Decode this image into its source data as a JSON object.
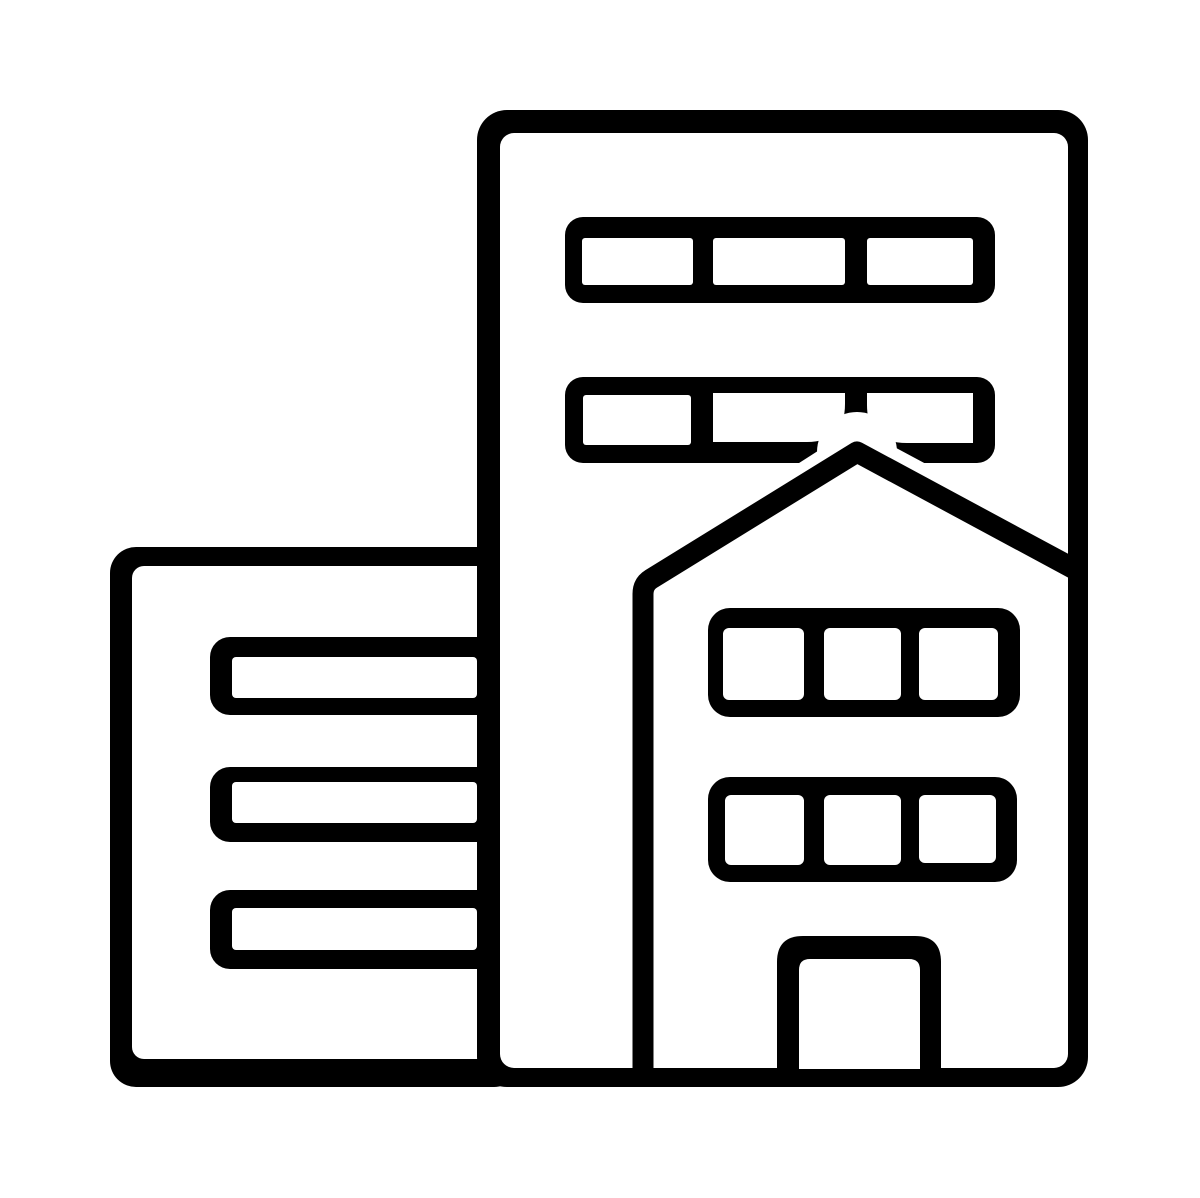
{
  "canvas": {
    "width": 1200,
    "height": 1198,
    "colors": {
      "ink": "#000000",
      "paper": "#ffffff"
    }
  },
  "icon": {
    "label": "city-buildings",
    "shapes": [
      {
        "name": "left-building-body",
        "type": "rect",
        "x": 110,
        "y": 547,
        "w": 410,
        "h": 540,
        "rx": 26,
        "fill": "ink"
      },
      {
        "name": "left-building-interior",
        "type": "rect",
        "x": 132,
        "y": 566,
        "w": 388,
        "h": 493,
        "rx": 12,
        "fill": "paper"
      },
      {
        "name": "left-window-bar-1",
        "type": "rect",
        "x": 210,
        "y": 637,
        "w": 310,
        "h": 78,
        "rx": 20,
        "fill": "ink"
      },
      {
        "name": "left-window-bar-1-glass",
        "type": "rect",
        "x": 232,
        "y": 657,
        "w": 245,
        "h": 41,
        "rx": 4,
        "fill": "paper"
      },
      {
        "name": "left-window-bar-2",
        "type": "rect",
        "x": 210,
        "y": 767,
        "w": 310,
        "h": 75,
        "rx": 20,
        "fill": "ink"
      },
      {
        "name": "left-window-bar-2-glass",
        "type": "rect",
        "x": 232,
        "y": 782,
        "w": 245,
        "h": 41,
        "rx": 4,
        "fill": "paper"
      },
      {
        "name": "left-window-bar-3",
        "type": "rect",
        "x": 210,
        "y": 890,
        "w": 310,
        "h": 79,
        "rx": 20,
        "fill": "ink"
      },
      {
        "name": "left-window-bar-3-glass",
        "type": "rect",
        "x": 232,
        "y": 908,
        "w": 245,
        "h": 42,
        "rx": 4,
        "fill": "paper"
      },
      {
        "name": "tall-building-body",
        "type": "rect",
        "x": 477,
        "y": 110,
        "w": 611,
        "h": 977,
        "rx": 30,
        "fill": "ink"
      },
      {
        "name": "tall-building-interior",
        "type": "rect",
        "x": 500,
        "y": 133,
        "w": 568,
        "h": 935,
        "rx": 14,
        "fill": "paper"
      },
      {
        "name": "top-window-band",
        "type": "rect",
        "x": 565,
        "y": 217,
        "w": 430,
        "h": 86,
        "rx": 18,
        "fill": "ink"
      },
      {
        "name": "top-window-band-glass-1",
        "type": "rect",
        "x": 582,
        "y": 238,
        "w": 111,
        "h": 47,
        "rx": 3,
        "fill": "paper"
      },
      {
        "name": "top-window-band-glass-2",
        "type": "rect",
        "x": 713,
        "y": 238,
        "w": 132,
        "h": 47,
        "rx": 3,
        "fill": "paper"
      },
      {
        "name": "top-window-band-glass-3",
        "type": "rect",
        "x": 867,
        "y": 238,
        "w": 106,
        "h": 47,
        "rx": 3,
        "fill": "paper"
      },
      {
        "name": "second-window-band",
        "type": "rect",
        "x": 565,
        "y": 377,
        "w": 430,
        "h": 86,
        "rx": 18,
        "fill": "ink"
      },
      {
        "name": "second-window-band-glass-1",
        "type": "rect",
        "x": 583,
        "y": 395,
        "w": 108,
        "h": 50,
        "rx": 3,
        "fill": "paper"
      },
      {
        "name": "second-window-band-glass-2",
        "type": "path",
        "d": "M713,393 H845 V404 Q845,442 807,442 H713 Z",
        "fill": "paper"
      },
      {
        "name": "second-window-band-glass-3",
        "type": "path",
        "d": "M867,393 H973 V443 H907 Q867,443 867,405 Z",
        "fill": "paper"
      },
      {
        "name": "roof-gap-halo",
        "type": "path",
        "d": "M648,586 L857,452 L1040,550",
        "stroke": "paper",
        "width": 44,
        "linecap": "round",
        "linejoin": "round"
      },
      {
        "name": "roof-apex-gap",
        "type": "circle",
        "cx": 857,
        "cy": 452,
        "r": 40,
        "fill": "paper"
      },
      {
        "name": "tower-roof-and-wall",
        "type": "path",
        "d": "M643,1080 L643,594 Q643,584 651,579 L857,452 L1078,571",
        "stroke": "ink",
        "width": 21,
        "linecap": "butt",
        "linejoin": "round"
      },
      {
        "name": "tower-window-band-upper",
        "type": "rect",
        "x": 708,
        "y": 608,
        "w": 312,
        "h": 109,
        "rx": 22,
        "fill": "ink"
      },
      {
        "name": "tower-window-upper-glass-1",
        "type": "rect",
        "x": 723,
        "y": 628,
        "w": 81,
        "h": 72,
        "rx": 6,
        "fill": "paper"
      },
      {
        "name": "tower-window-upper-glass-2",
        "type": "rect",
        "x": 824,
        "y": 628,
        "w": 77,
        "h": 72,
        "rx": 6,
        "fill": "paper"
      },
      {
        "name": "tower-window-upper-glass-3",
        "type": "rect",
        "x": 919,
        "y": 628,
        "w": 79,
        "h": 72,
        "rx": 6,
        "fill": "paper"
      },
      {
        "name": "tower-window-band-lower",
        "type": "rect",
        "x": 708,
        "y": 777,
        "w": 309,
        "h": 105,
        "rx": 22,
        "fill": "ink"
      },
      {
        "name": "tower-window-lower-glass-1",
        "type": "rect",
        "x": 725,
        "y": 795,
        "w": 79,
        "h": 70,
        "rx": 6,
        "fill": "paper"
      },
      {
        "name": "tower-window-lower-glass-2",
        "type": "rect",
        "x": 824,
        "y": 795,
        "w": 77,
        "h": 70,
        "rx": 6,
        "fill": "paper"
      },
      {
        "name": "tower-window-lower-glass-3",
        "type": "rect",
        "x": 919,
        "y": 795,
        "w": 77,
        "h": 68,
        "rx": 6,
        "fill": "paper"
      },
      {
        "name": "door-frame",
        "type": "path",
        "d": "M777,1075 V962 Q777,936 803,936 H915 Q941,936 941,962 V1075 Z",
        "fill": "ink"
      },
      {
        "name": "door-opening",
        "type": "path",
        "d": "M799,1069 V970 Q799,959 810,959 H909 Q920,959 920,970 V1069 Z",
        "fill": "paper"
      }
    ]
  }
}
